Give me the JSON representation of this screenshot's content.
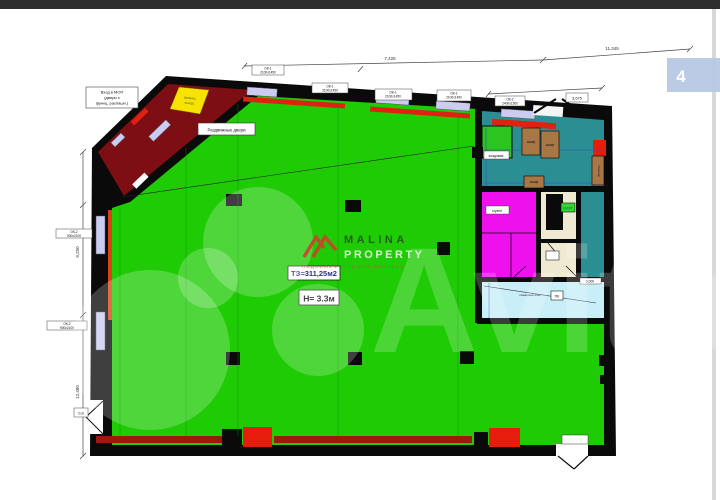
{
  "page": {
    "badge": "4"
  },
  "watermark": {
    "brand": "Avito",
    "logo_line1": "MALINA",
    "logo_line2": "PROPERTY",
    "logo_tagline": "НЕДВИЖИМОСТЬ ДЛЯ БИЗНЕСА"
  },
  "plan": {
    "area": "ТЗ=311,25м2",
    "height": "Н= 3.3м",
    "sliding_doors": "Раздвижные двери",
    "entry_note": {
      "l1": "Вход в МОП",
      "l2": "(двери с",
      "l3": "функц. распашн.)"
    },
    "evac": {
      "l1": "эвакуац.",
      "l2": "выход"
    },
    "lift": "ЛИФТ",
    "wc": "с/узел",
    "storage": "кладовая",
    "wardrobe": "шкаф",
    "shelf": "стеллаж",
    "fire_box": "ПК",
    "fire_note": "пожарный кран",
    "door_width": "0,9",
    "level_mark": "0,000"
  },
  "windows": {
    "mark_top": "ОК-1",
    "size_top": "2100х1450",
    "mark_left": "ОК-2",
    "size_left": "900х2100",
    "spec_mark": "ОК-2",
    "spec_size": "2400х1500"
  },
  "dims": {
    "d1": "7,425",
    "d2": "11,345",
    "d3": "3,675",
    "d4": "9,250",
    "d5": "12,480"
  }
}
